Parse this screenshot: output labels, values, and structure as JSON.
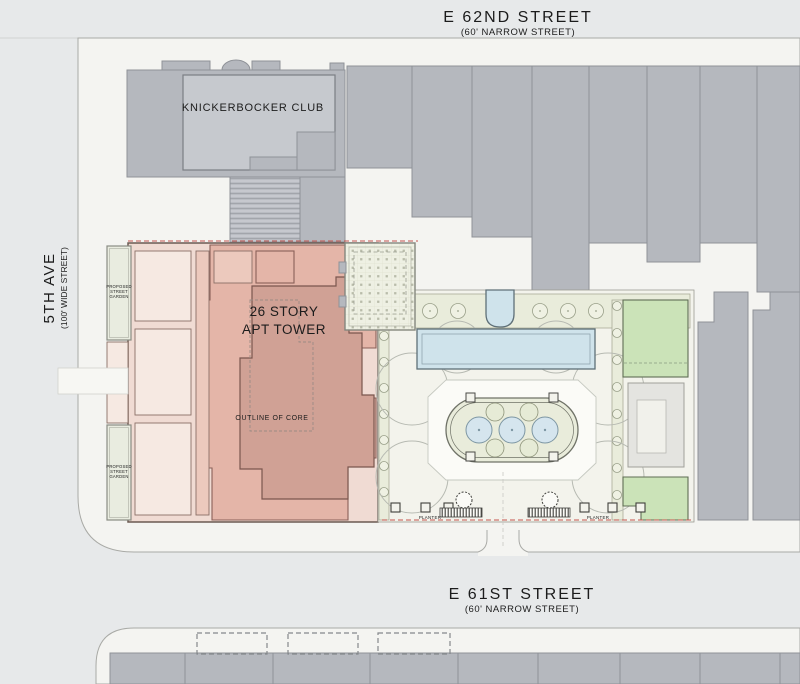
{
  "streets": {
    "e62nd": {
      "name": "E 62ND STREET",
      "subtitle": "(60' NARROW STREET)"
    },
    "e61st": {
      "name": "E 61ST STREET",
      "subtitle": "(60' NARROW STREET)"
    },
    "fifth_ave": {
      "name": "5TH AVE",
      "subtitle": "(100' WIDE STREET)"
    }
  },
  "buildings": {
    "knickerbocker_club": "KNICKERBOCKER CLUB",
    "apt_tower": {
      "line1": "26 STORY",
      "line2": "APT TOWER",
      "core": "OUTLINE OF CORE"
    }
  },
  "site": {
    "street_garden": {
      "line1": "PROPOSED",
      "line2": "STREET",
      "line3": "GARDEN"
    },
    "planter_left": "PLANTER",
    "planter_right": "PLANTER"
  },
  "colors": {
    "street_gray": "#e7e9ea",
    "sidewalk": "#f4f4f1",
    "building_gray": "#b5b8be",
    "building_gray_light": "#c6c9ce",
    "tower_parcel_light": "#f0dbd3",
    "tower_mid_pink": "#e4b5a8",
    "tower_core_pink": "#d0a195",
    "water_blue": "#cfe3eb",
    "lawn_green": "#cbe3b8",
    "planting_green": "#e9ecdb",
    "street_garden_green": "#e9ece0",
    "lot_line_red": "#c4554e"
  }
}
